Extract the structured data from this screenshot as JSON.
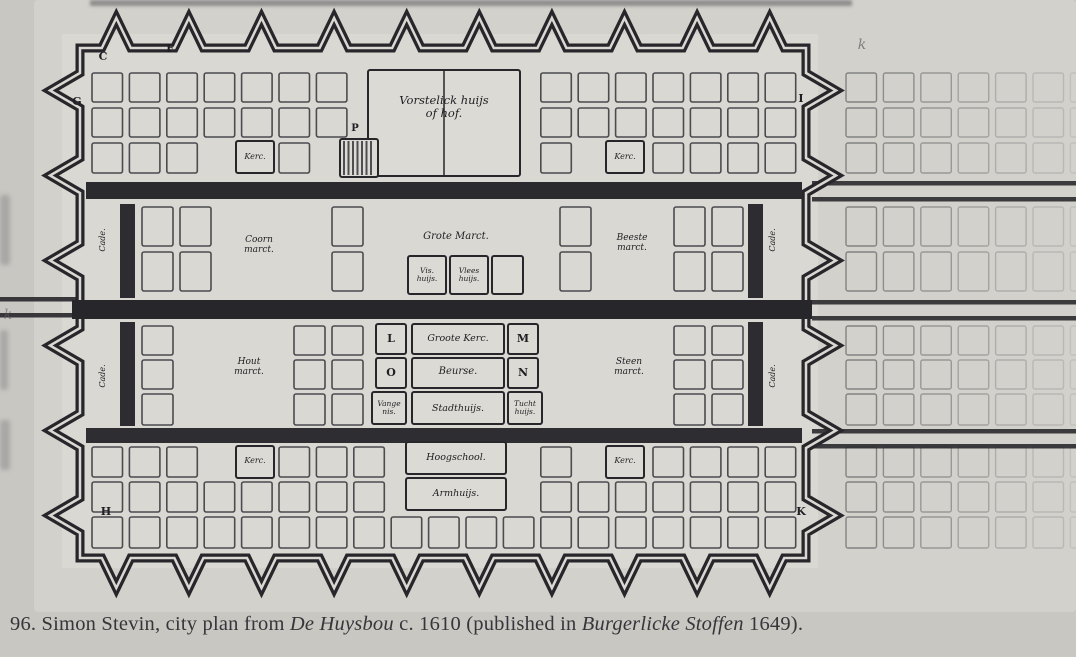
{
  "page": {
    "caption": {
      "parts": [
        {
          "text": "96. Simon Stevin, city plan from ",
          "style": "roman"
        },
        {
          "text": "De Huysbou",
          "style": "italic"
        },
        {
          "text": " c. 1610 (published in ",
          "style": "roman"
        },
        {
          "text": "Burgerlicke Stoffen",
          "style": "italic"
        },
        {
          "text": " 1649).",
          "style": "roman"
        }
      ]
    }
  },
  "plan": {
    "labels": {
      "palace": "Vorstelick huijs\nof hof.",
      "kerc_top_left": "Kerc.",
      "kerc_top_right": "Kerc.",
      "kerc_bottom_left": "Kerc.",
      "kerc_bottom_right": "Kerc.",
      "coorn_marct": "Coorn\nmarct.",
      "grote_marct": "Grote Marct.",
      "beeste_marct": "Beeste\nmarct.",
      "vis_huijs": "Vis.\nhuijs.",
      "vlees_huijs": "Vlees\nhuijs.",
      "hout_marct": "Hout\nmarct.",
      "steen_marct": "Steen\nmarct.",
      "groote_kerc": "Groote Kerc.",
      "beurse": "Beurse.",
      "stadthuijs": "Stadthuijs.",
      "vangenis": "Vange\nnis.",
      "tucht_huijs": "Tucht\nhuijs.",
      "hoogschool": "Hoogschool.",
      "armhuijs": "Armhuijs.",
      "cade": "Cade.",
      "letters": {
        "C": "C",
        "F": "F",
        "G": "G",
        "H": "H",
        "I": "I",
        "K": "K",
        "L": "L",
        "M": "M",
        "N": "N",
        "O": "O",
        "P": "P"
      },
      "pencil_mark": "k"
    },
    "colors": {
      "page_bg": "#c9c7c2",
      "paper": "#d3d1cb",
      "interior": "#dad8d2",
      "block": "#dcdad4",
      "ink": "#26262b",
      "canal": "#2a2a2f",
      "grid": "#4b4b50",
      "faint_grid": "#6e6e6e"
    }
  }
}
